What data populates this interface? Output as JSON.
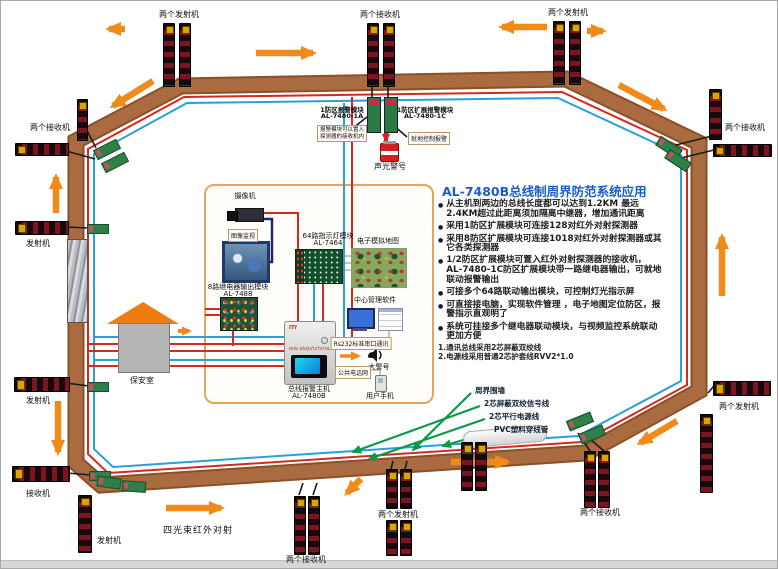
{
  "colors": {
    "band": "#aa6b40",
    "band_edge": "#8a5028",
    "red_wire": "#d42a1e",
    "blue_wire": "#2b9fd8",
    "arrow_orange": "#f08a19",
    "arrow_green": "#0a9a44",
    "title_blue": "#1b5cc8"
  },
  "title": "AL-7480B总线制周界防范系统应用",
  "bullets": [
    "从主机到两边的总线长度都可以达到1.2KM 最远2.4KM超过此距离须加隔离中继器，增加通讯距离",
    "采用1防区扩展模块可连接128对红外对射探测器",
    "采用8防区扩展模块可连接1018对红外对射探测器或其它各类探测器",
    "1/2防区扩展模块可置入红外对射探测器的接收机，AL-7480-1C防区扩展模块带一路继电器输出，可就地联动报警输出",
    "可接多个64路联动输出模块，可控制灯光指示屏",
    "可直接接电脑，实现软件管理 ，电子地图定位防区，报警指示直观明了",
    "系统可挂接多个继电器联动模块，与视频监控系统联动更加方便"
  ],
  "notes": [
    "1.通讯总线采用2芯屏蔽双绞线",
    "2.电源线采用普通2芯护套线RVV2*1.0"
  ],
  "device_labels": [
    {
      "name": "top-left-transmitters",
      "text": "两个发射机"
    },
    {
      "name": "top-receivers",
      "text": "两个接收机"
    },
    {
      "name": "top-right-transmitters",
      "text": "两个发射机"
    },
    {
      "name": "left-corner-receivers",
      "text": "两个接收机"
    },
    {
      "name": "left-transmitter-1",
      "text": "发射机"
    },
    {
      "name": "left-transmitter-2",
      "text": "发射机"
    },
    {
      "name": "left-receiver",
      "text": "接收机"
    },
    {
      "name": "bottom-transmitter",
      "text": "发射机"
    },
    {
      "name": "four-beam-ir",
      "text": "四光束红外对射"
    },
    {
      "name": "bottom-receivers",
      "text": "两个接收机"
    },
    {
      "name": "bottom-transmitters",
      "text": "两个发射机"
    },
    {
      "name": "bottom-right-receivers",
      "text": "两个接收机"
    },
    {
      "name": "right-top-receivers",
      "text": "两个接收机"
    },
    {
      "name": "right-transmitters",
      "text": "两个发射机"
    }
  ],
  "callouts": [
    {
      "text": "周界围墙"
    },
    {
      "text": "2芯屏蔽双绞信号线"
    },
    {
      "text": "2芯平行电源线"
    },
    {
      "text": "PVC塑料穿线管"
    }
  ],
  "zone_modules": {
    "left_line1": "1防区报警模块",
    "left_line2": "AL-7480-1A",
    "right_line1": "1防区扩展报警模块",
    "right_line2": "AL-7480-1C",
    "note_left_line1": "报警模块可以置入",
    "note_left_line2": "探测器的接收机内",
    "note_right": "就地控制报警",
    "siren_label": "声光警号"
  },
  "security_room": "保安室",
  "panel": {
    "camera": "摄像机",
    "monitor": "图像监视",
    "relay_line1": "8路继电器输出模块",
    "relay_line2": "AL-7488",
    "led_line1": "64路指示灯模块",
    "led_line2": "AL-7464",
    "map": "电子模拟地图",
    "software": "中心管理软件",
    "host_line1": "总线报警主机",
    "host_line2": "AL-7480B",
    "rs232": "Rs232标准串口通讯",
    "horn": "大警号",
    "pstn": "公共电话网",
    "phone": "用户手机",
    "brand": "ITI",
    "watermark": "ww.alephchina."
  }
}
